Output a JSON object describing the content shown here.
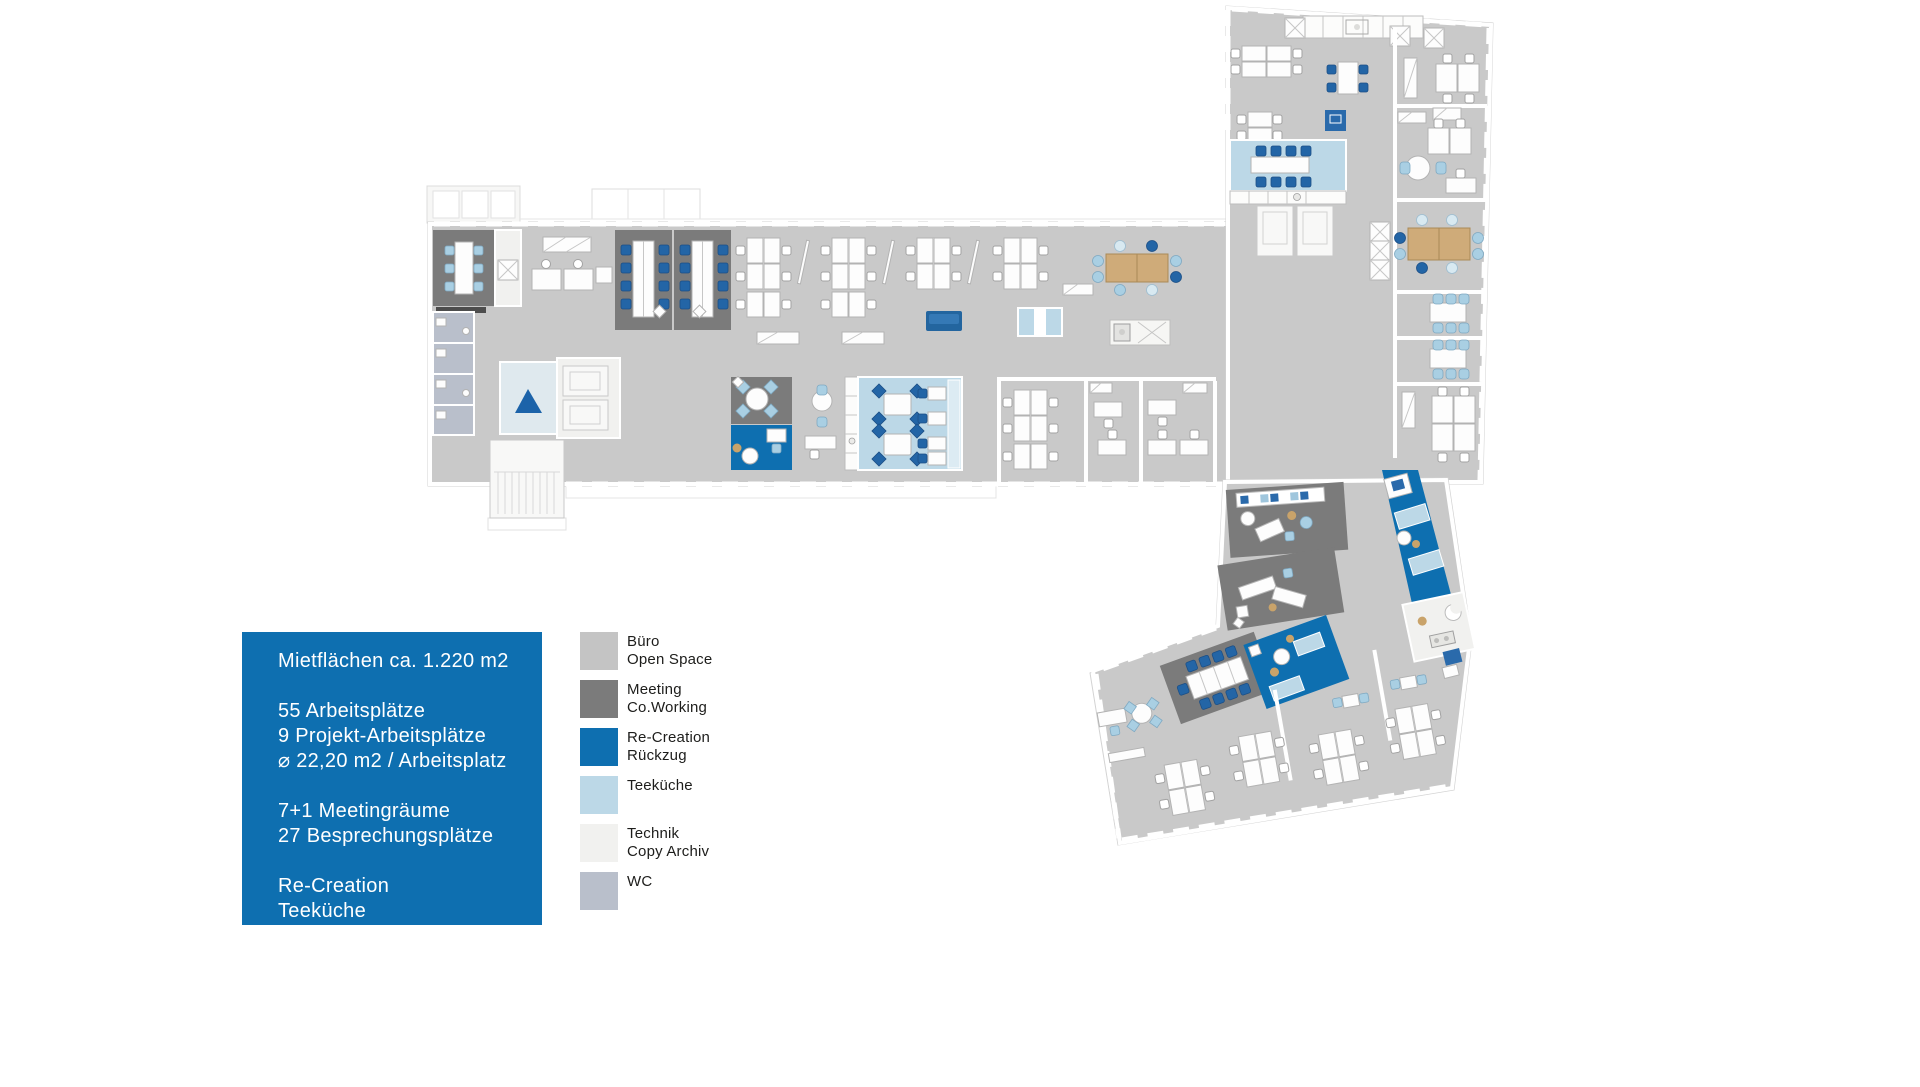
{
  "info_box": {
    "bg": "#0e6fb0",
    "title": "Mietflächen ca. 1.220 m2",
    "groups": [
      [
        "55 Arbeitsplätze",
        "9 Projekt-Arbeitsplätze",
        "⌀ 22,20 m2 / Arbeitsplatz"
      ],
      [
        "7+1 Meetingräume",
        "27 Besprechungsplätze"
      ],
      [
        "Re-Creation",
        "Teeküche"
      ]
    ]
  },
  "legend": {
    "items": [
      {
        "key": "buero-open-space",
        "color": "#c4c4c4",
        "label": [
          "Büro",
          "Open Space"
        ]
      },
      {
        "key": "meeting-coworking",
        "color": "#7b7b7b",
        "label": [
          "Meeting",
          "Co.Working"
        ]
      },
      {
        "key": "re-creation-rueckzug",
        "color": "#0e6fb0",
        "label": [
          "Re-Creation",
          "Rückzug"
        ]
      },
      {
        "key": "teekueche",
        "color": "#bcd8e7",
        "label": [
          "Teeküche"
        ]
      },
      {
        "key": "technik-copy-archiv",
        "color": "#f1f1ef",
        "label": [
          "Technik",
          "Copy Archiv"
        ]
      },
      {
        "key": "wc",
        "color": "#b9bfcb",
        "label": [
          "WC"
        ]
      }
    ]
  },
  "floorplan": {
    "colors": {
      "floor": "#c9c9c9",
      "meeting": "#7b7b7b",
      "blue": "#0e6fb0",
      "tk": "#bcd8e7",
      "tech": "#f1f1ef",
      "wc": "#b9bfcb",
      "wood": "#cfab79",
      "chair-lb": "#a9cfe3",
      "chair-db": "#2365a6"
    }
  }
}
